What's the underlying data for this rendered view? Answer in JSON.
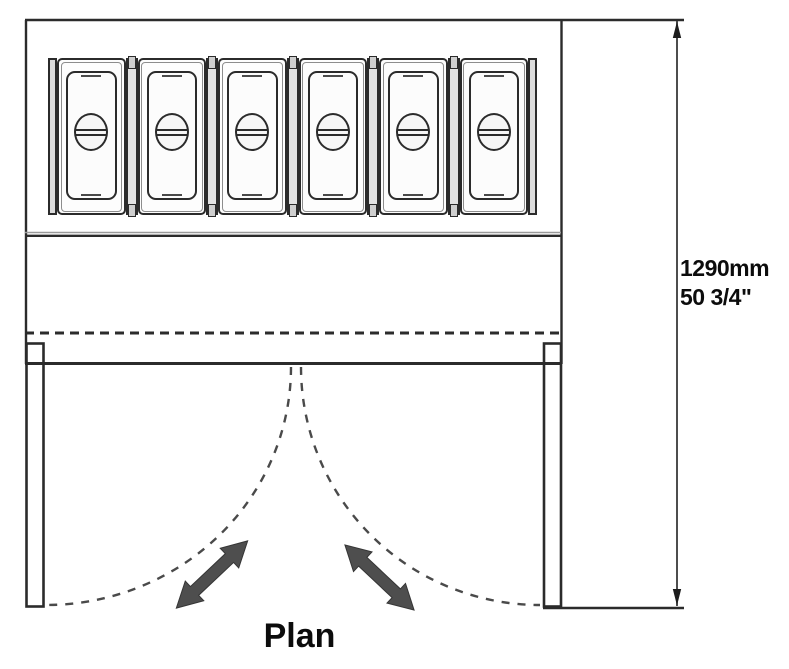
{
  "diagram": {
    "caption": "Plan",
    "dimension": {
      "metric": "1290mm",
      "imperial": "50 3/4\""
    },
    "pan_count": 6,
    "door_count": 2,
    "swing_arrows": [
      {
        "name": "swing-arrow-left",
        "direction": "down-left"
      },
      {
        "name": "swing-arrow-right",
        "direction": "down-right"
      }
    ],
    "colors": {
      "line": "#2b2b2b",
      "dash": "#4a4a4a",
      "arrow": "#4e4e4e",
      "paper": "#ffffff",
      "panel": "#e2e2e2"
    }
  }
}
